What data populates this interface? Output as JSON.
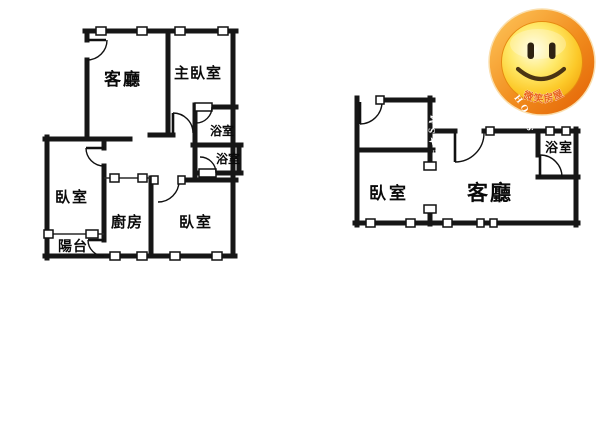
{
  "image": {
    "type": "real-estate floor plan image, two apartment plans side by side",
    "background": "#ffffff"
  },
  "colors": {
    "wall": "#161616",
    "thin_line": "#2a2a2a",
    "label": "#0a0a0a",
    "window_fill": "#ffffff"
  },
  "left_plan": {
    "living_room": "客廳",
    "master_bedroom": "主臥室",
    "bathroom_upper": "浴室",
    "bathroom_lower": "浴室",
    "bedroom_left": "臥室",
    "kitchen": "廚房",
    "bedroom_bottom": "臥室",
    "balcony": "陽台"
  },
  "right_plan": {
    "bedroom": "臥室",
    "living_room": "客廳",
    "bathroom": "浴室"
  },
  "badge": {
    "ring_text": "HOUSE★SMILE★HOUSE★SMILE",
    "bottom_text": "微笑房屋",
    "ring_color": "#ef7d17",
    "face_color": "#ffd23e",
    "feature_color": "#3a2a10",
    "ring_text_color": "#ffffff",
    "bottom_text_color": "#e8601a"
  }
}
